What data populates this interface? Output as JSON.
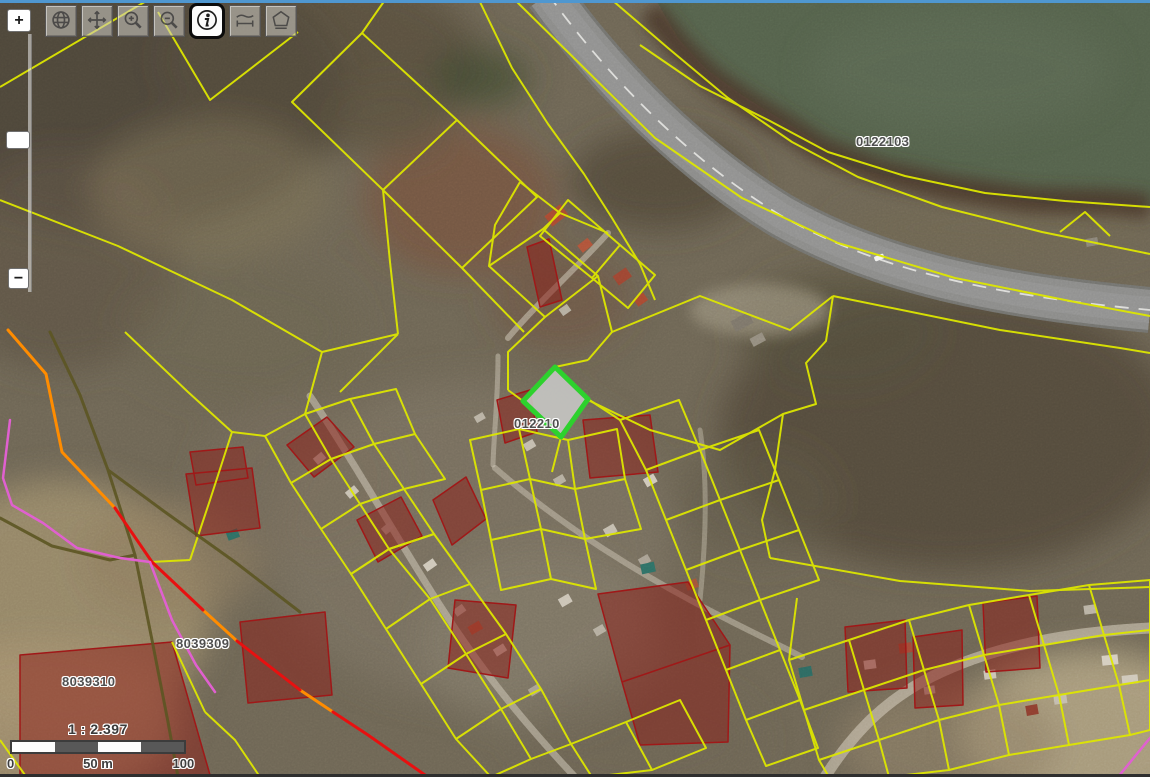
{
  "window": {
    "top_border_color": "#4f97d0"
  },
  "toolbar": {
    "tools": [
      {
        "id": "full-extent",
        "icon": "globe-icon",
        "active": false
      },
      {
        "id": "pan",
        "icon": "pan-arrows-icon",
        "active": false
      },
      {
        "id": "zoom-in-tool",
        "icon": "magnifier-plus-icon",
        "active": false
      },
      {
        "id": "zoom-out-tool",
        "icon": "magnifier-minus-icon",
        "active": false
      },
      {
        "id": "identify",
        "icon": "info-icon",
        "active": true
      },
      {
        "id": "measure-distance",
        "icon": "ruler-icon",
        "active": false
      },
      {
        "id": "measure-area",
        "icon": "area-polygon-icon",
        "active": false
      }
    ]
  },
  "zoom_control": {
    "zoom_in": "+",
    "zoom_out": "−"
  },
  "scale_bar": {
    "ratio": "1 : 2.397",
    "tick_start": "0",
    "tick_mid": "50 m",
    "tick_end": "100 m"
  },
  "parcel_labels": [
    {
      "text": "0122103"
    },
    {
      "text": "012210"
    },
    {
      "text": "8039309"
    },
    {
      "text": "8039310"
    }
  ],
  "map_colors": {
    "parcel_line": "#dde600",
    "selected_parcel": "#2dd12d",
    "selected_fill": "#c6c6c4",
    "restricted_fill": "#8c1c16",
    "restricted_stroke": "#a01818",
    "boundary_orange": "#ff8c00",
    "boundary_red": "#e81010",
    "boundary_magenta": "#e060d0",
    "path_olive": "#5c5522",
    "water": "#55624c",
    "road": "#8b8b89"
  }
}
